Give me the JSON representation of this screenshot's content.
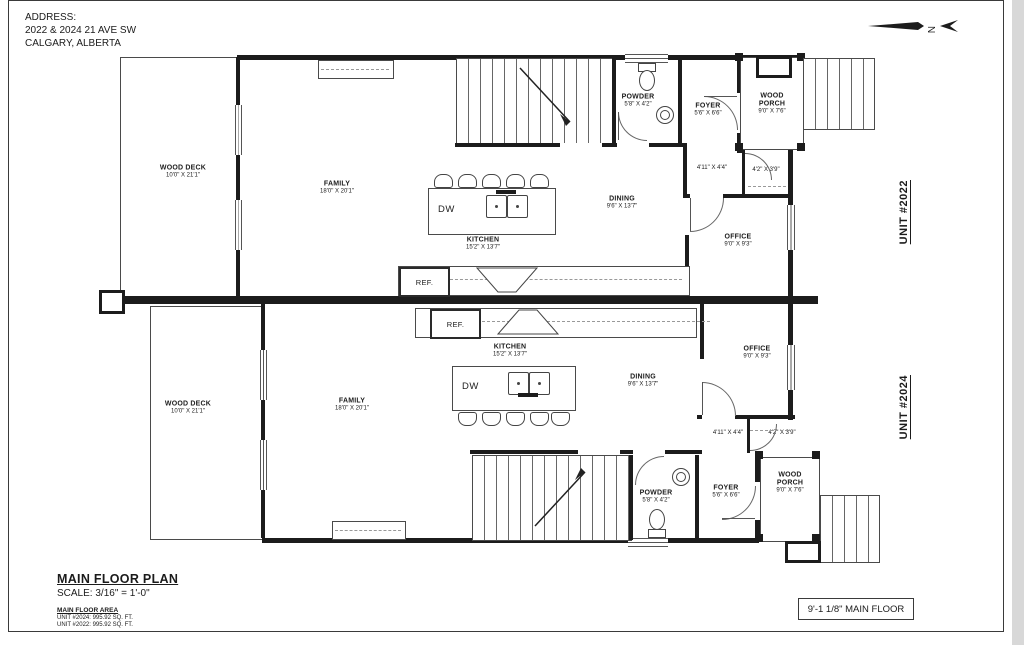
{
  "sheet": {
    "address_label": "ADDRESS:",
    "address_line1": "2022 & 2024 21 AVE SW",
    "address_line2": "CALGARY, ALBERTA",
    "compass_letter": "N"
  },
  "unit_labels": {
    "top": "UNIT #2022",
    "bottom": "UNIT #2024"
  },
  "rooms": {
    "wood_deck": {
      "name": "WOOD DECK",
      "dims": "10'0\" X 21'1\""
    },
    "family": {
      "name": "FAMILY",
      "dims": "18'0\" X 20'1\""
    },
    "kitchen": {
      "name": "KITCHEN",
      "dims": "15'2\" X 13'7\""
    },
    "dining": {
      "name": "DINING",
      "dims": "9'6\" X 13'7\""
    },
    "powder": {
      "name": "POWDER",
      "dims": "5'8\" X 4'2\""
    },
    "foyer": {
      "name": "FOYER",
      "dims": "5'6\" X 6'6\""
    },
    "wood_porch": {
      "name": "WOOD PORCH",
      "dims": "9'0\" X 7'6\""
    },
    "office": {
      "name": "OFFICE",
      "dims": "9'0\" X 9'3\""
    },
    "hall_dims": "4'11\" X 4'4\"",
    "closet_dims": "4'2\" X 3'9\"",
    "appliances": {
      "dishwasher": "DW",
      "fridge": "REF."
    }
  },
  "footer": {
    "plan_title": "MAIN FLOOR PLAN",
    "scale": "SCALE: 3/16\" = 1'-0\"",
    "area_heading": "MAIN FLOOR AREA",
    "area_unit_2024": "UNIT #2024: 995.92 SQ. FT.",
    "area_unit_2022": "UNIT #2022: 995.92 SQ. FT.",
    "floor_height_note": "9'-1 1/8\" MAIN FLOOR"
  },
  "colors": {
    "wall": "#1c1c1c",
    "thin_line": "#4a4a4a",
    "paper": "#ffffff",
    "text": "#1b1b1b"
  }
}
